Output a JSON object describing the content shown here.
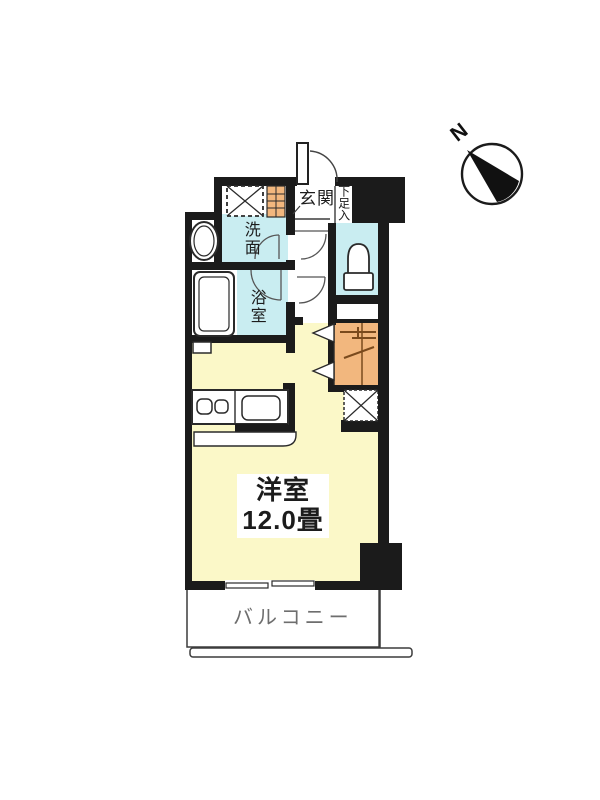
{
  "floor_plan": {
    "compass": {
      "north_label": "N"
    },
    "rooms": {
      "entrance": {
        "label": "玄関"
      },
      "shoe_storage": {
        "label": "下足入"
      },
      "washroom": {
        "label": "洗面"
      },
      "bathroom": {
        "label": "浴室"
      },
      "main_room": {
        "label": "洋室",
        "size": "12.0畳"
      },
      "balcony": {
        "label": "バルコニー"
      }
    },
    "fixtures": [
      "entry-door",
      "washing-machine-pad",
      "shoe-cabinet",
      "washbasin",
      "bathtub",
      "toilet",
      "closet-hanger-pipe",
      "folding-closet-door",
      "kitchen-stove",
      "kitchen-sink",
      "storage-cross-box",
      "sliding-window",
      "compass-north-arrow"
    ],
    "colors": {
      "wall_black": "#1b1b1b",
      "water_rooms_cyan": "#c9edf1",
      "main_room_yellow": "#fbf8c8",
      "closet_orange": "#f2b77e",
      "line_gray": "#3c3c3c",
      "balcony_text_gray": "#6e6e6e"
    }
  }
}
